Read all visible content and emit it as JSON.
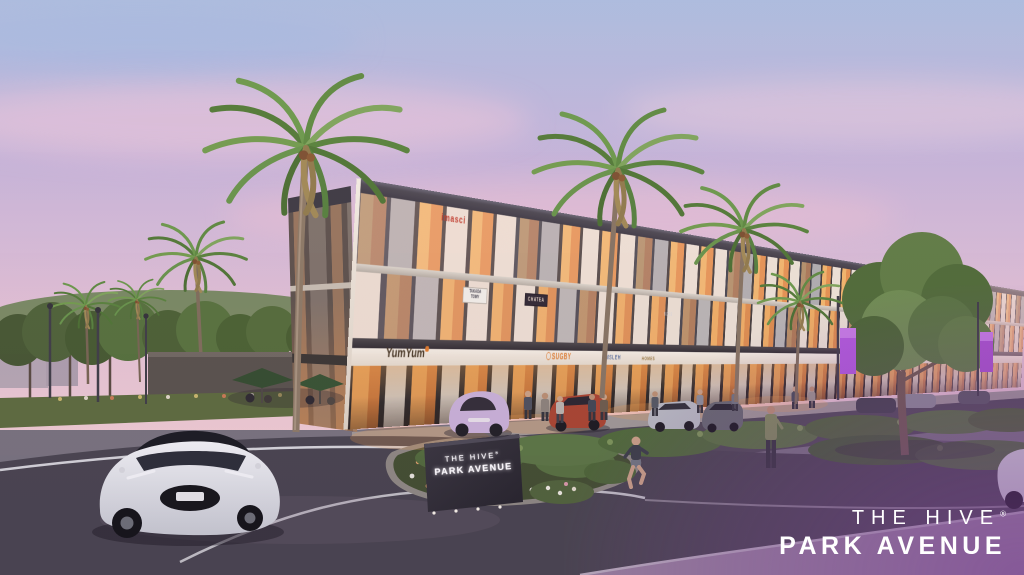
{
  "scene": {
    "type": "architectural-rendering",
    "setting": "Dusk street view of a three-storey retail building with palm trees, parked cars, pedestrians and a landscaped median"
  },
  "branding": {
    "logo_line1": "THE HIVE",
    "logo_registered": "®",
    "logo_line2": "PARK AVENUE"
  },
  "monument": {
    "line1": "THE HIVE",
    "registered": "®",
    "line2": "PARK AVENUE"
  },
  "signs": {
    "floor3_red": "imasci",
    "floor2_a_line1": "TAKADA",
    "floor2_a_line2": "TOMY",
    "floor2_b": "CHATEA",
    "ground_a": "YumYum",
    "ground_b": "SUGBY",
    "ground_c": "UMSLEH",
    "ground_d": "HOMES",
    "window": "BOSS"
  },
  "palette": {
    "sky_top": "#a9bcdf",
    "sky_pink": "#eec6d6",
    "facade_cream": "#f0e8da",
    "frame_bronze": "#45403a",
    "window_glow": "#f2b468",
    "canopy_dark": "#3e3a40",
    "road": "#45424b",
    "foliage": "#5d7c41",
    "banner_purple": "#b157de",
    "overlay_purple": "#7b3f96",
    "logo_white": "#ffffff"
  }
}
